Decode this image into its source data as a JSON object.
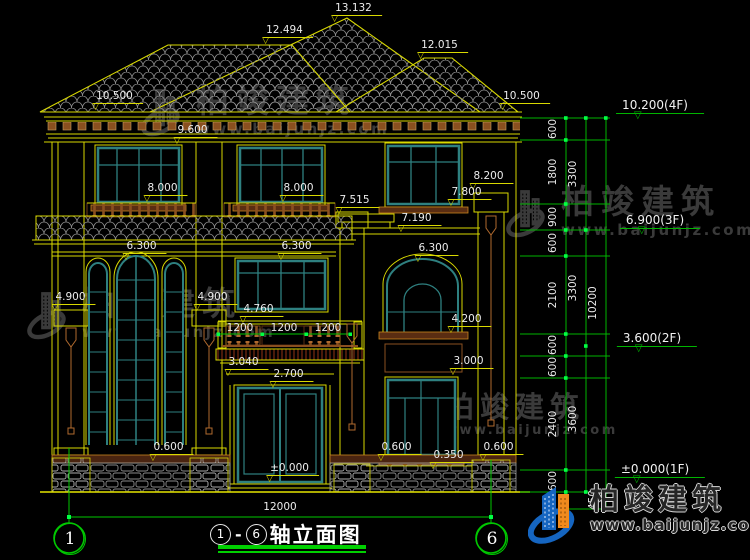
{
  "drawing": {
    "name": "front-elevation",
    "title": {
      "axis_start": "1",
      "axis_end": "6",
      "text": "轴立面图"
    },
    "axis_bubbles": {
      "left": "1",
      "right": "6"
    },
    "annotations": {
      "elevations": [
        {
          "text": "13.132",
          "x": 357,
          "y": 2
        },
        {
          "text": "12.494",
          "x": 288,
          "y": 24
        },
        {
          "text": "12.015",
          "x": 443,
          "y": 39
        },
        {
          "text": "10.500",
          "x": 118,
          "y": 90
        },
        {
          "text": "10.500",
          "x": 525,
          "y": 90
        },
        {
          "text": "9.600",
          "x": 196,
          "y": 124
        },
        {
          "text": "8.000",
          "x": 166,
          "y": 182
        },
        {
          "text": "8.000",
          "x": 302,
          "y": 182
        },
        {
          "text": "8.200",
          "x": 492,
          "y": 170
        },
        {
          "text": "7.800",
          "x": 470,
          "y": 186
        },
        {
          "text": "7.515",
          "x": 358,
          "y": 194
        },
        {
          "text": "7.190",
          "x": 420,
          "y": 212
        },
        {
          "text": "6.300",
          "x": 145,
          "y": 240
        },
        {
          "text": "6.300",
          "x": 300,
          "y": 240
        },
        {
          "text": "6.300",
          "x": 437,
          "y": 242
        },
        {
          "text": "4.900",
          "x": 74,
          "y": 291
        },
        {
          "text": "4.900",
          "x": 216,
          "y": 291
        },
        {
          "text": "4.760",
          "x": 262,
          "y": 303
        },
        {
          "text": "4.200",
          "x": 470,
          "y": 313
        },
        {
          "text": "3.040",
          "x": 247,
          "y": 356
        },
        {
          "text": "3.000",
          "x": 472,
          "y": 355
        },
        {
          "text": "2.700",
          "x": 292,
          "y": 368
        },
        {
          "text": "0.600",
          "x": 172,
          "y": 441
        },
        {
          "text": "0.600",
          "x": 400,
          "y": 441
        },
        {
          "text": "0.350",
          "x": 452,
          "y": 449
        },
        {
          "text": "0.600",
          "x": 502,
          "y": 441
        },
        {
          "text": "±0.000",
          "x": 293,
          "y": 462
        }
      ],
      "plain_dims": [
        {
          "text": "1200",
          "x": 240,
          "y": 322
        },
        {
          "text": "1200",
          "x": 284,
          "y": 322
        },
        {
          "text": "1200",
          "x": 328,
          "y": 322
        },
        {
          "text": "12000",
          "x": 280,
          "y": 501
        }
      ],
      "vertical_dims": [
        {
          "text": "600",
          "x": 553,
          "y": 129
        },
        {
          "text": "1800",
          "x": 553,
          "y": 172
        },
        {
          "text": "900",
          "x": 553,
          "y": 217
        },
        {
          "text": "600",
          "x": 553,
          "y": 243
        },
        {
          "text": "2100",
          "x": 553,
          "y": 295
        },
        {
          "text": "600",
          "x": 553,
          "y": 345
        },
        {
          "text": "600",
          "x": 553,
          "y": 367
        },
        {
          "text": "2400",
          "x": 553,
          "y": 424
        },
        {
          "text": "600",
          "x": 553,
          "y": 481
        },
        {
          "text": "3300",
          "x": 573,
          "y": 174
        },
        {
          "text": "3300",
          "x": 573,
          "y": 288
        },
        {
          "text": "3600",
          "x": 573,
          "y": 419
        },
        {
          "text": "10200",
          "x": 593,
          "y": 303
        },
        {
          "text": "450",
          "x": 593,
          "y": 500
        }
      ],
      "levels": [
        {
          "text": "10.200(4F)",
          "x": 660,
          "y": 99
        },
        {
          "text": "6.900(3F)",
          "x": 660,
          "y": 214
        },
        {
          "text": "3.600(2F)",
          "x": 657,
          "y": 332
        },
        {
          "text": "±0.000(1F)",
          "x": 660,
          "y": 463
        }
      ]
    }
  },
  "watermark": {
    "brand": "柏竣建筑",
    "url": "www.baijunjz.com"
  },
  "colors": {
    "line_yellow": "#d9d900",
    "dim_green": "#00c400",
    "tick_green": "#00ff44",
    "window_teal": "#2e8080",
    "trim_brown": "#a0622a",
    "text_white": "#ececec"
  }
}
